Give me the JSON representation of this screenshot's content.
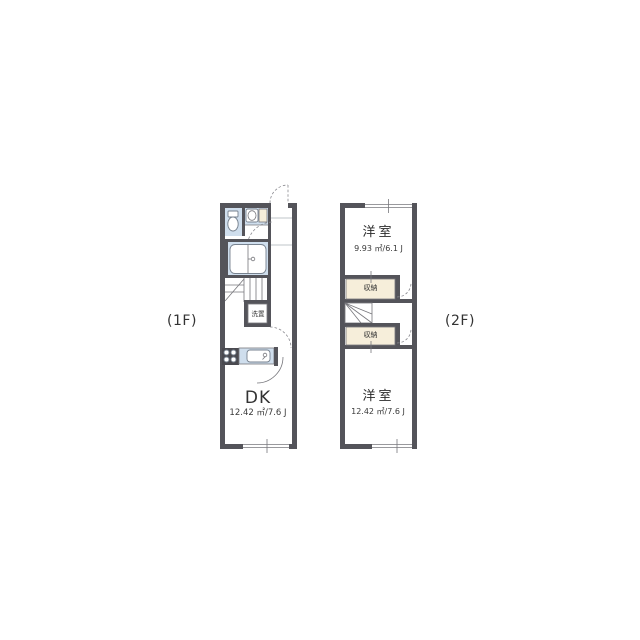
{
  "page": {
    "background": "#ffffff",
    "type": "floor-plan"
  },
  "colors": {
    "wall": "#54545a",
    "fixture_blue": "#cfdeed",
    "closet_beige": "#f6eeda",
    "line": "#77777c",
    "text": "#2a2a2a"
  },
  "floor1": {
    "label": "(1F)",
    "rooms": {
      "dk": {
        "name": "DK",
        "area": "12.42 ㎡/7.6 J"
      },
      "laundry": {
        "name": "洗置"
      }
    },
    "icons": [
      "toilet-icon",
      "washbasin-icon",
      "bathtub-icon",
      "staircase-icon",
      "stove-icon",
      "kitchen-sink-icon",
      "entry-door-arc",
      "window",
      "door-arc"
    ]
  },
  "floor2": {
    "label": "(2F)",
    "rooms": {
      "bedroom_upper": {
        "name": "洋室",
        "area": "9.93 ㎡/6.1 J"
      },
      "closet_upper": {
        "name": "収納"
      },
      "closet_lower": {
        "name": "収納"
      },
      "bedroom_lower": {
        "name": "洋室",
        "area": "12.42 ㎡/7.6 J"
      }
    },
    "icons": [
      "staircase-icon",
      "window",
      "door-arc",
      "sliding-door-tick"
    ]
  }
}
